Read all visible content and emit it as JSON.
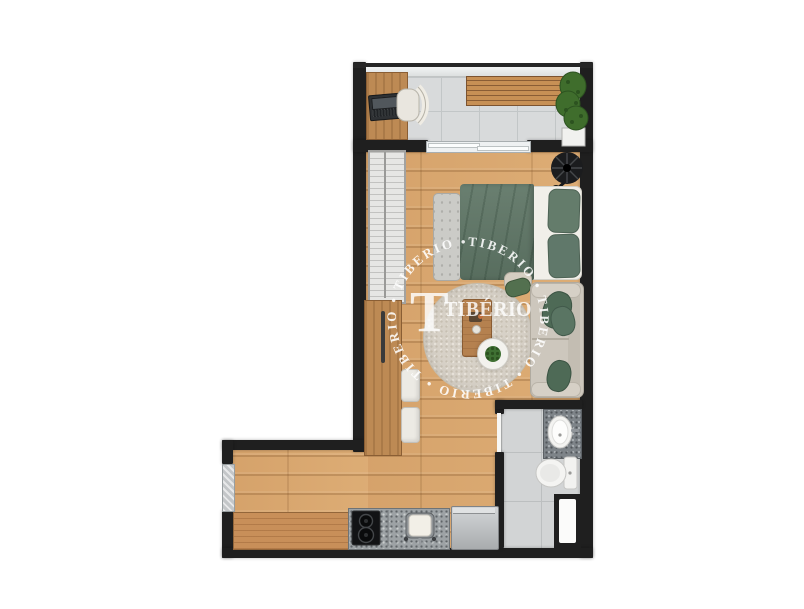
{
  "canvas": {
    "width": 804,
    "height": 609,
    "background": "#ffffff"
  },
  "watermark": {
    "brand_initial": "T",
    "brand_name": "TIBÉRIO",
    "ring_text": "TIBERIO • TIBERIO • TIBERIO • TIBERIO • TIBERIO • ",
    "color": "#ffffff"
  },
  "palette": {
    "wall": "#1f1f1f",
    "wood_floor": "#d9a871",
    "balcony_tile": "#d8dadb",
    "bathroom_tile": "#d2d4d5",
    "furniture_wood": "#bd8a54",
    "duvet_green": "#5d7464",
    "pillow_green": "#4f6b57",
    "sofa_beige": "#cdc7bd",
    "rug_beige": "#d7d1c7",
    "granite_gray": "#9da2a5",
    "fixture_white": "#f4f4f2",
    "plant_green": "#3f6d2c"
  },
  "rooms": [
    {
      "id": "balcony",
      "name": "balcony-terrace"
    },
    {
      "id": "bedroom_living",
      "name": "bedroom-living-area"
    },
    {
      "id": "kitchen",
      "name": "kitchen"
    },
    {
      "id": "bathroom",
      "name": "bathroom"
    }
  ],
  "furniture": [
    "desk",
    "laptop",
    "office-chair",
    "slatted-bench",
    "potted-plant",
    "wardrobe",
    "tall-cabinet",
    "stools",
    "floor-lamp",
    "foot-bench",
    "double-bed",
    "round-rug",
    "coffee-table",
    "side-table",
    "sofa",
    "vanity-sink",
    "toilet",
    "shower-window",
    "kitchen-counter",
    "cooktop",
    "kitchen-sink",
    "appliance"
  ]
}
